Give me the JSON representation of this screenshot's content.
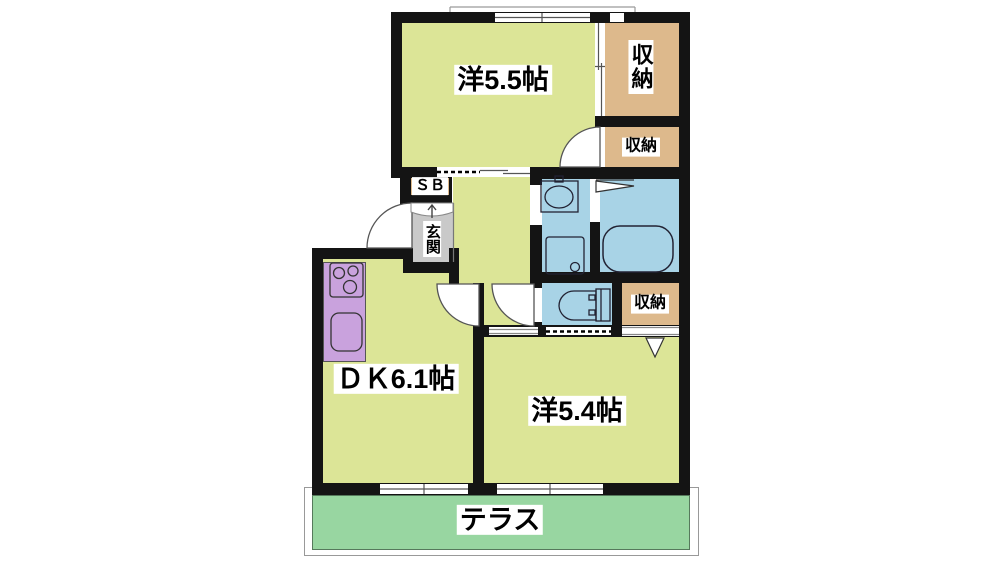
{
  "title": "apartment floor plan",
  "rooms": {
    "west55": {
      "label": "洋5.5帖"
    },
    "closet1": {
      "label": "収納"
    },
    "closet2": {
      "label": "収納"
    },
    "shoebox": {
      "label": "ＳＢ"
    },
    "entrance": {
      "label": "玄関"
    },
    "closet3": {
      "label": "収納"
    },
    "dk": {
      "label": "ＤＫ6.1帖"
    },
    "west54": {
      "label": "洋5.4帖"
    },
    "terrace": {
      "label": "テラス"
    }
  },
  "colors": {
    "room_yellow": "#dce597",
    "closet_tan": "#ddb98c",
    "wet_blue": "#a8d3e6",
    "kitchen_purple": "#c9a2dd",
    "terrace_green": "#98d6a1",
    "entrance_grey": "#c9c9c9",
    "wall_black": "#141414"
  }
}
